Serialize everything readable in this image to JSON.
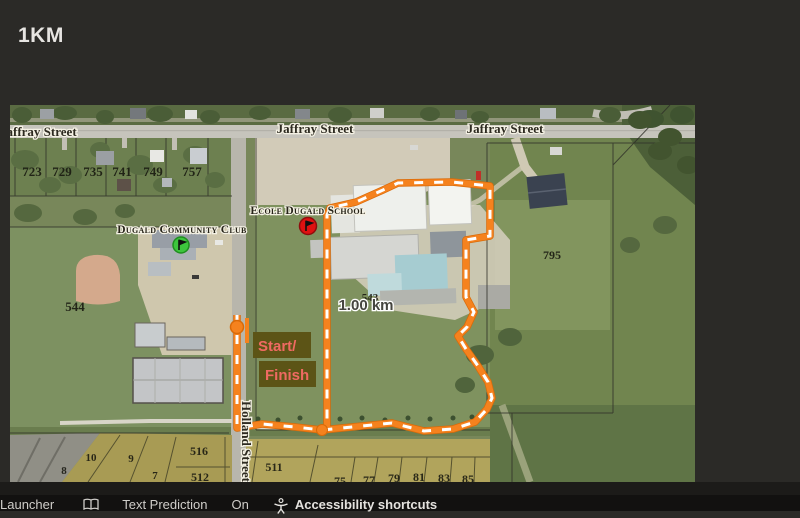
{
  "header": {
    "title": "1KM"
  },
  "map": {
    "streets": {
      "jaffray_left": "Jaffray Street",
      "jaffray_center": "Jaffray Street",
      "jaffray_right": "Jaffray Street",
      "holland": "Holland Street"
    },
    "places": {
      "community_club": "Dugald Community Club",
      "school": "Ecole Dugald School"
    },
    "route": {
      "distance_label": "1.00 km",
      "start_line": "Start/",
      "finish_line": "Finish",
      "route_color": "#f5821e",
      "label_bg": "#5c5416",
      "label_color": "#ef6a62"
    },
    "markers": {
      "community_club_color": "#3dc53d",
      "school_color": "#e01111",
      "start_color": "#f5821e"
    },
    "lots": {
      "top_row": [
        "723",
        "729",
        "735",
        "741",
        "749",
        "757"
      ],
      "field_left": "544",
      "school_field": "543",
      "east": "795",
      "bottom_left": [
        "8",
        "10",
        "9",
        "7"
      ],
      "bottom_mid": [
        "516",
        "512",
        "511"
      ],
      "bottom_right": [
        "75",
        "77",
        "79",
        "81",
        "83",
        "85"
      ]
    }
  },
  "taskbar": {
    "launcher": "Launcher",
    "text_prediction": "Text Prediction",
    "text_prediction_state": "On",
    "accessibility": "Accessibility shortcuts"
  }
}
